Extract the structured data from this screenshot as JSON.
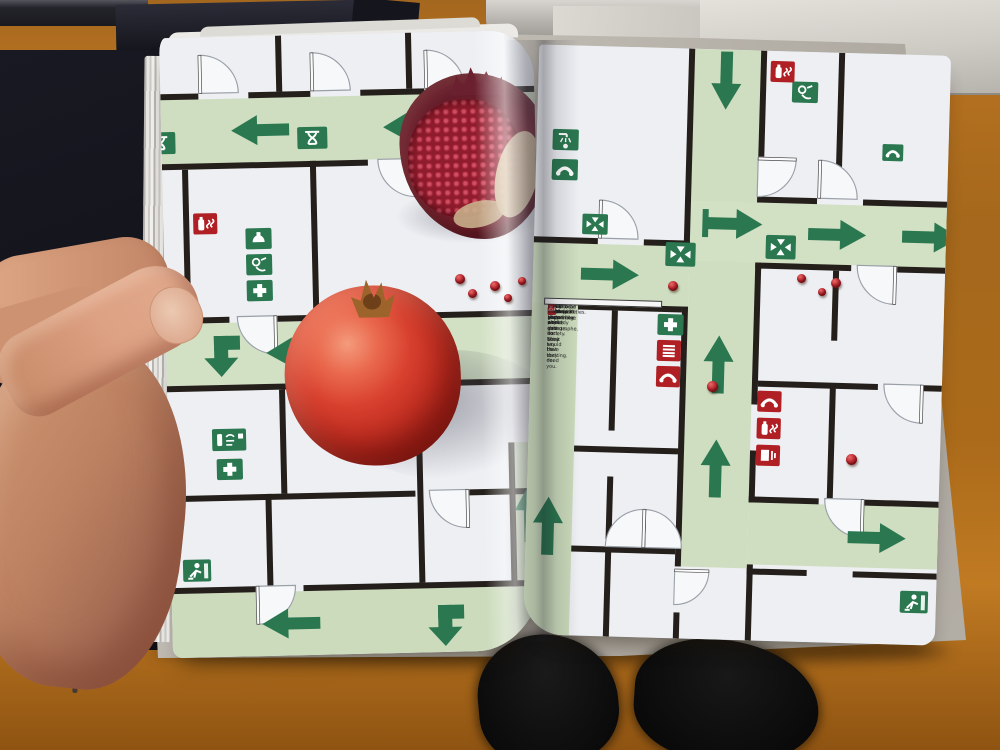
{
  "scene": {
    "description": "Photograph of a hand holding open an art book; the spread is an emergency evacuation floor-plan pattern with green escape-route corridors, safety signs and pomegranates photographed on top; wooden floor, table with books, and the reader's feet are visible."
  },
  "statements": {
    "items": [
      {
        "icon": "first-aid-cross",
        "tone": "green",
        "glyph": "+",
        "text": "Every day I go to work and do what I have to do."
      },
      {
        "icon": "emergency-phone",
        "tone": "green",
        "glyph": "☎",
        "text": "You have your palace in society. They say that they need you."
      },
      {
        "icon": "stretcher",
        "tone": "green",
        "glyph": "▬",
        "text": "But nothing happens."
      },
      {
        "icon": "safety-shower",
        "tone": "green",
        "glyph": "☂",
        "text": "I have responsibilities."
      },
      {
        "icon": "eye-wash-bottle",
        "tone": "green",
        "glyph": "♒",
        "text": "Would be so great if something would change."
      },
      {
        "icon": "eye-wash-station",
        "tone": "green",
        "glyph": "◉",
        "text": "It has to come from somewhere else."
      },
      {
        "icon": "fire-extinguisher",
        "tone": "red",
        "glyph": "♨",
        "text": "It has to be like an act of god, like a catastrophe."
      },
      {
        "icon": "fire-phone",
        "tone": "red",
        "glyph": "☎",
        "text": "I don't want that anybody gets hurt, but it would be exciting."
      },
      {
        "icon": "fire-alarm",
        "tone": "red",
        "glyph": "⚠",
        "text": "Just a small earthquake."
      }
    ]
  },
  "plan": {
    "left_page_icons": [
      "pharmacy",
      "fire-extinguisher",
      "breathing-mask",
      "eye-wash",
      "first-aid-cross",
      "eye-wash-station",
      "emergency-exit-running-man"
    ],
    "right_page_icons": [
      "assembly-point",
      "safety-shower",
      "emergency-phone",
      "eye-wash",
      "first-aid-cross",
      "fire-blanket",
      "fire-phone",
      "fire-extinguisher",
      "fire-alarm",
      "emergency-exit-running-man"
    ]
  },
  "palette": {
    "corridor_green": "#cfdec0",
    "sign_green": "#2a7750",
    "sign_red": "#b01f23",
    "wall": "#241f1a",
    "page": "#edeff3",
    "cover_cardboard": "#b9b4ab",
    "wood_floor": "#b4671c",
    "dark_poster": "#15151d",
    "skin": "#d8a185",
    "pomegranate_red": "#c22f22"
  }
}
